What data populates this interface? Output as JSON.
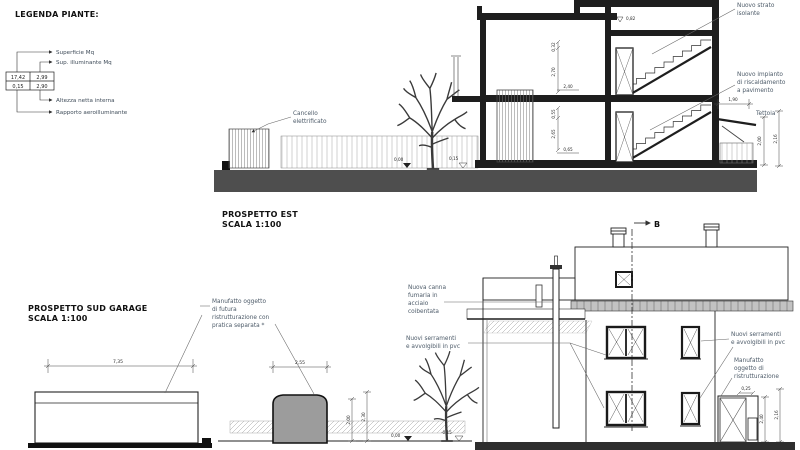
{
  "legend": {
    "title": "LEGENDA PIANTE:",
    "labels": [
      "Superficie Mq",
      "Sup. illuminante Mq",
      "Altezza netta interna",
      "Rapporto aeroilluminante"
    ],
    "values": {
      "superficie": "17,42",
      "illuminante": "2,99",
      "rapporto": "0,15",
      "altezza": "2,90"
    }
  },
  "titles": {
    "est1": "PROSPETTO EST",
    "est2": "SCALA 1:100",
    "sud1": "PROSPETTO SUD GARAGE",
    "sud2": "SCALA 1:100"
  },
  "section": {
    "cancello": [
      "Cancello",
      "elettrificato"
    ],
    "strato": [
      "Nuovo strato",
      "isolante"
    ],
    "impianto": [
      "Nuovo impianto",
      "di riscaldamento",
      "a pavimento"
    ],
    "tettoia": "Tettoia",
    "dims": {
      "w190": "1,90",
      "h200": "2,00",
      "h216": "2,16",
      "l082": "0,82",
      "v032": "0,32",
      "v270": "2,70",
      "w240": "2,40",
      "v055": "0,55",
      "v265": "2,65",
      "w065": "0,65",
      "lvl_zero": "0,00",
      "lvl_curb": "0,15"
    }
  },
  "garage": {
    "manufatto": [
      "Manufatto oggetto",
      "di futura",
      "ristrutturazione con",
      "pratica separata *"
    ],
    "dims": {
      "w735": "7,35",
      "w255": "2,55",
      "h200": "2,00",
      "h230": "2,30",
      "lvl_zero": "0,00",
      "lvl_minus": "-0,15"
    }
  },
  "house": {
    "marker": "B",
    "canna": [
      "Nuova canna",
      "fumaria in",
      "acciaio",
      "coibentata"
    ],
    "serramenti": [
      "Nuovi serramenti",
      "e avvolgibili in pvc"
    ],
    "manufatto": [
      "Manufatto",
      "oggetto di",
      "ristrutturazione"
    ],
    "dims": {
      "w025": "0,25",
      "h240": "2,40",
      "h216": "2,16"
    }
  }
}
